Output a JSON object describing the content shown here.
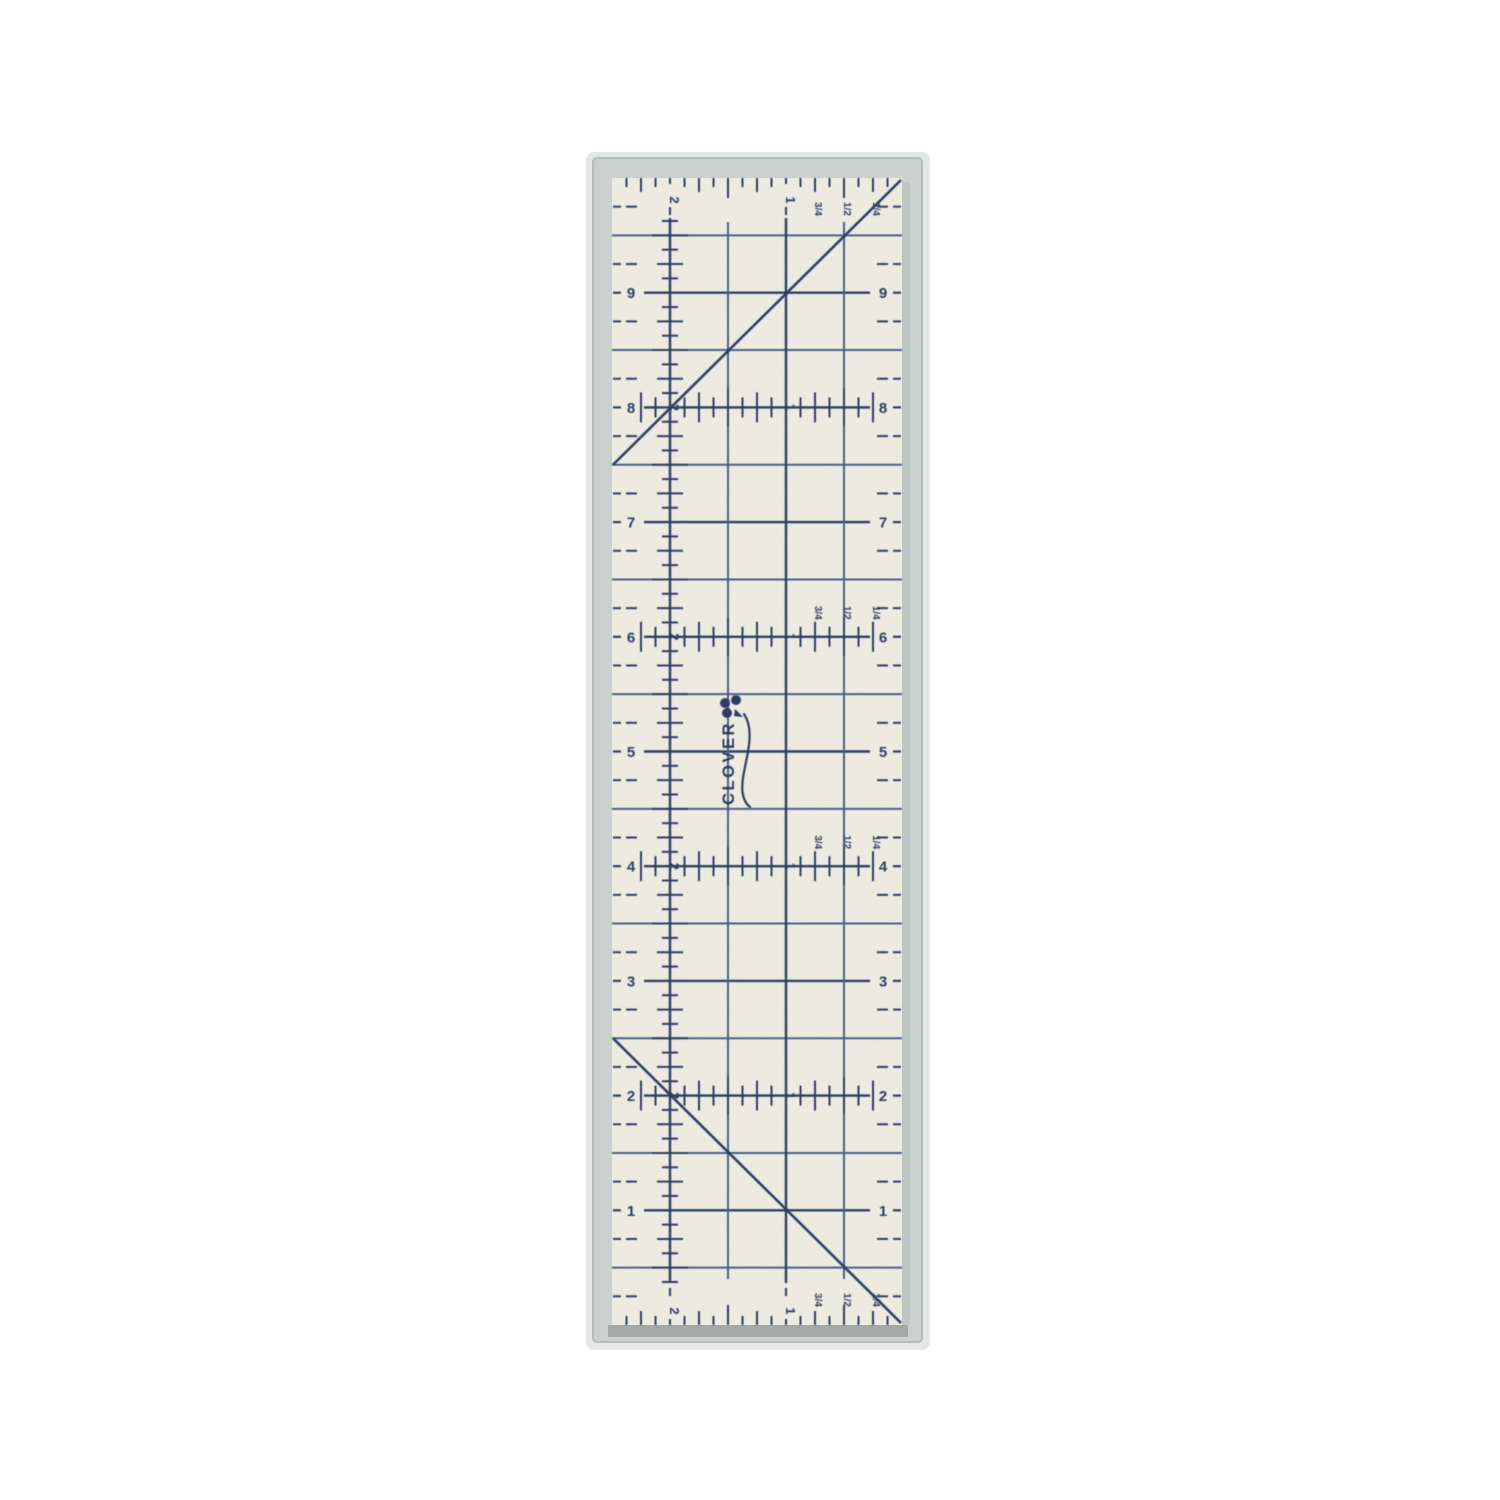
{
  "photo": {
    "background_color": "#ffffff"
  },
  "ruler": {
    "brand_text": "CLOVER",
    "left_inch_labels": [
      "9",
      "8",
      "7",
      "6",
      "5",
      "4",
      "3",
      "2",
      "1"
    ],
    "right_inch_labels": [
      "9",
      "8",
      "7",
      "6",
      "5",
      "4",
      "3",
      "2",
      "1"
    ],
    "width_scale_labels": [
      "2",
      "1"
    ],
    "fraction_labels": [
      "3/4",
      "1/2",
      "1/4"
    ],
    "scale_row_inches": [
      8,
      6,
      4,
      2
    ],
    "fraction_scale_rows": [
      "top-edge",
      "6",
      "4",
      "bottom-edge"
    ],
    "diagonal_line_count": 2,
    "colors": {
      "background": "#ffffff",
      "face": "#f1eee3",
      "marking": "#2f3d63",
      "marking_light": "#4d5d86",
      "backing": "#cbd1ce",
      "backing_edge": "#b6bcb9",
      "backing_shadow": "#a3a9a4",
      "halo": "#e3e7e5"
    }
  }
}
